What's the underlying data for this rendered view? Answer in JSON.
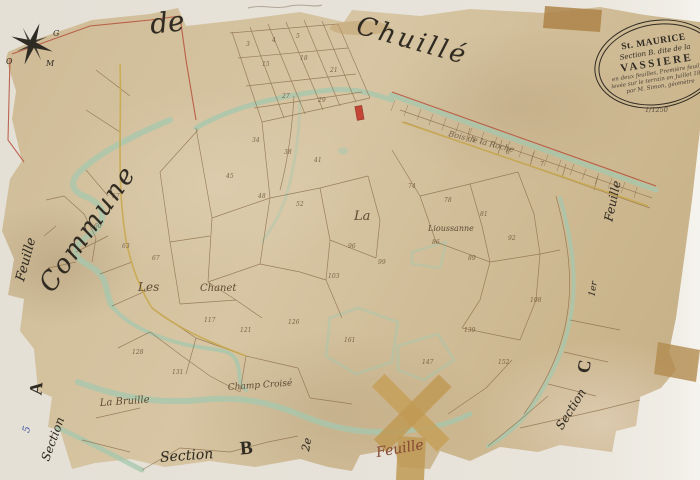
{
  "cartouche": {
    "title": "St. MAURICE",
    "subtitle": "Section B. dite de la",
    "name": "VASSIERE",
    "note1": "en deux feuilles, Première feuille",
    "note2": "levée sur le terrain en Juillet 1839",
    "note3": "par M. Simon, géomètre",
    "scale": "1/1250"
  },
  "margins": {
    "commune": "Commune",
    "de": "de",
    "chuille": "Chuillé",
    "left_feuille": "Feuille",
    "left_letter": "A",
    "left_section": "Section",
    "left_blue_mark": "5",
    "bottom_section": "Section",
    "bottom_letter": "B",
    "bottom_deuxieme": "2e",
    "bottom_feuille": "Feuille",
    "bottom_right_section": "Section",
    "right_feuille": "Feuille",
    "right_premier": "1er",
    "right_letter": "C"
  },
  "compass": {
    "letter_ne": "G",
    "letter_w": "O",
    "letter_se": "M"
  },
  "place_names": {
    "bois": "Bois de la Roche",
    "la": "La",
    "lioussanne": "Lioussanne",
    "les": "Les",
    "chanet": "Chanet",
    "bruille": "La Bruille",
    "champ": "Champ Croisé"
  },
  "parcel_numbers": [
    "3",
    "4",
    "5",
    "15",
    "18",
    "21",
    "27",
    "29",
    "34",
    "38",
    "41",
    "45",
    "48",
    "52",
    "57",
    "60",
    "63",
    "67",
    "74",
    "78",
    "81",
    "86",
    "89",
    "92",
    "96",
    "99",
    "103",
    "108",
    "117",
    "121",
    "126",
    "128",
    "131",
    "139",
    "147",
    "152",
    "161",
    "5",
    "6",
    "7"
  ],
  "colors": {
    "paper": "#d2bf9c",
    "scan_background": "#e8e4db",
    "ink_sepia": "#8a6d49",
    "stream_green": "#a5c8ae",
    "boundary_red": "#b5503b",
    "road_yellow": "#c9a94f",
    "tape_tan": "#c09a55",
    "building_red": "#c24535",
    "blue_mark": "#4a5fae"
  }
}
